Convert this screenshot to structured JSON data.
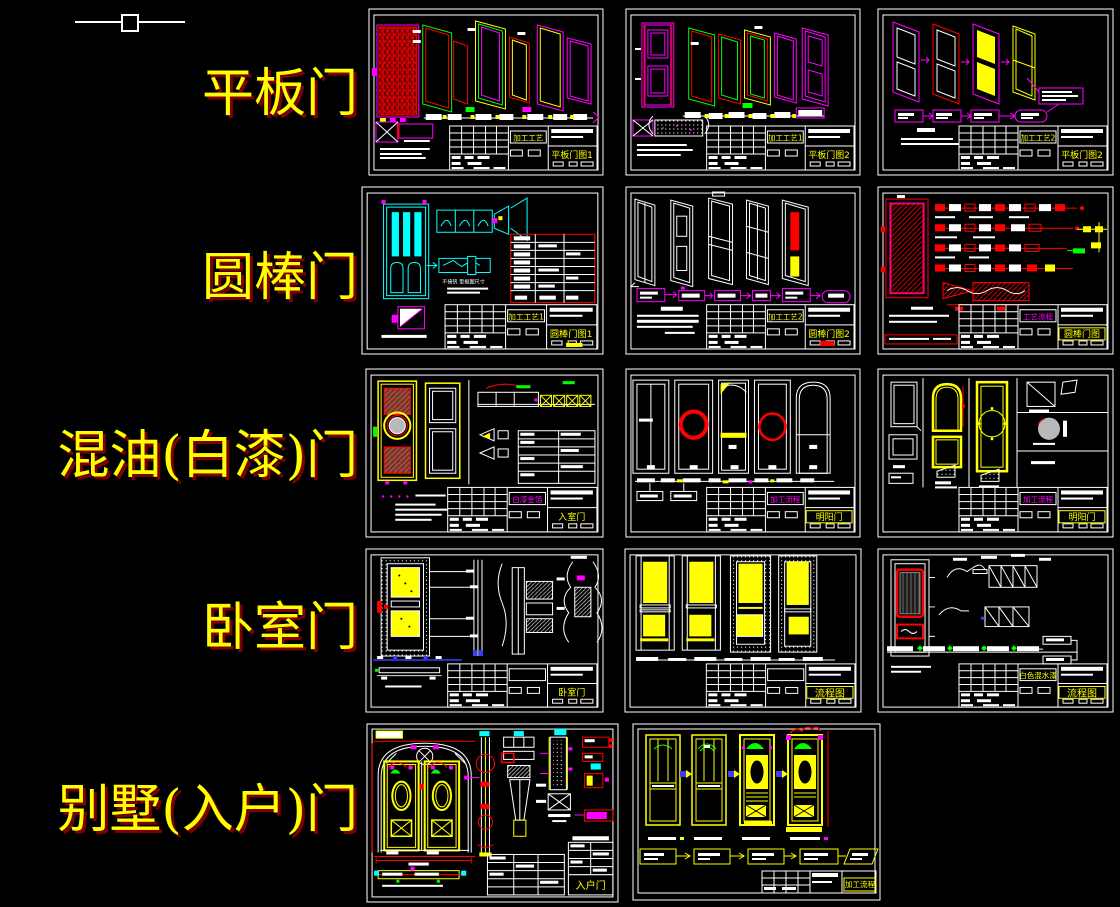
{
  "canvas": {
    "background": "#000000",
    "type": "cad-model-space"
  },
  "cursor": {
    "type": "crosshair-with-pickbox"
  },
  "colors": {
    "label_yellow": "#ffff00",
    "label_shadow": "#7e0000",
    "cad_white": "#ffffff",
    "cad_red": "#ff0000",
    "cad_magenta": "#ff00ff",
    "cad_green": "#00ff00",
    "cad_cyan": "#00ffff",
    "cad_yellow": "#ffff00"
  },
  "row_labels": {
    "r1": "平板门",
    "r2": "圆棒门",
    "r3": "混油(白漆)门",
    "r4": "卧室门",
    "r5": "别墅(入户)门"
  },
  "sheets": {
    "r1s1": {
      "process": "加工工艺",
      "name": "平板门图1"
    },
    "r1s2": {
      "process": "加工工艺1",
      "name": "平板门图2"
    },
    "r1s3": {
      "process": "加工工艺2",
      "name": "平板门图2"
    },
    "r2s1": {
      "process": "加工工艺1",
      "name": "圆棒门图1",
      "note": "不接钒 型棍图尺寸"
    },
    "r2s2": {
      "process": "加工工艺2",
      "name": "圆棒门图2"
    },
    "r2s3": {
      "process": "工艺流程",
      "name": "圆棒门图"
    },
    "r3s1": {
      "process": "白漆金箔",
      "name": "入室门"
    },
    "r3s2": {
      "process": "加工流程",
      "name": "明阳门"
    },
    "r3s3": {
      "process": "加工流程",
      "name": "明阳门"
    },
    "r4s1": {
      "name": "卧室门"
    },
    "r4s2": {
      "name": "流程图"
    },
    "r4s3": {
      "process": "白色混水漆",
      "name": "流程图"
    },
    "r5s1": {
      "name": "入户门"
    },
    "r5s2": {
      "name": "加工流程"
    }
  }
}
